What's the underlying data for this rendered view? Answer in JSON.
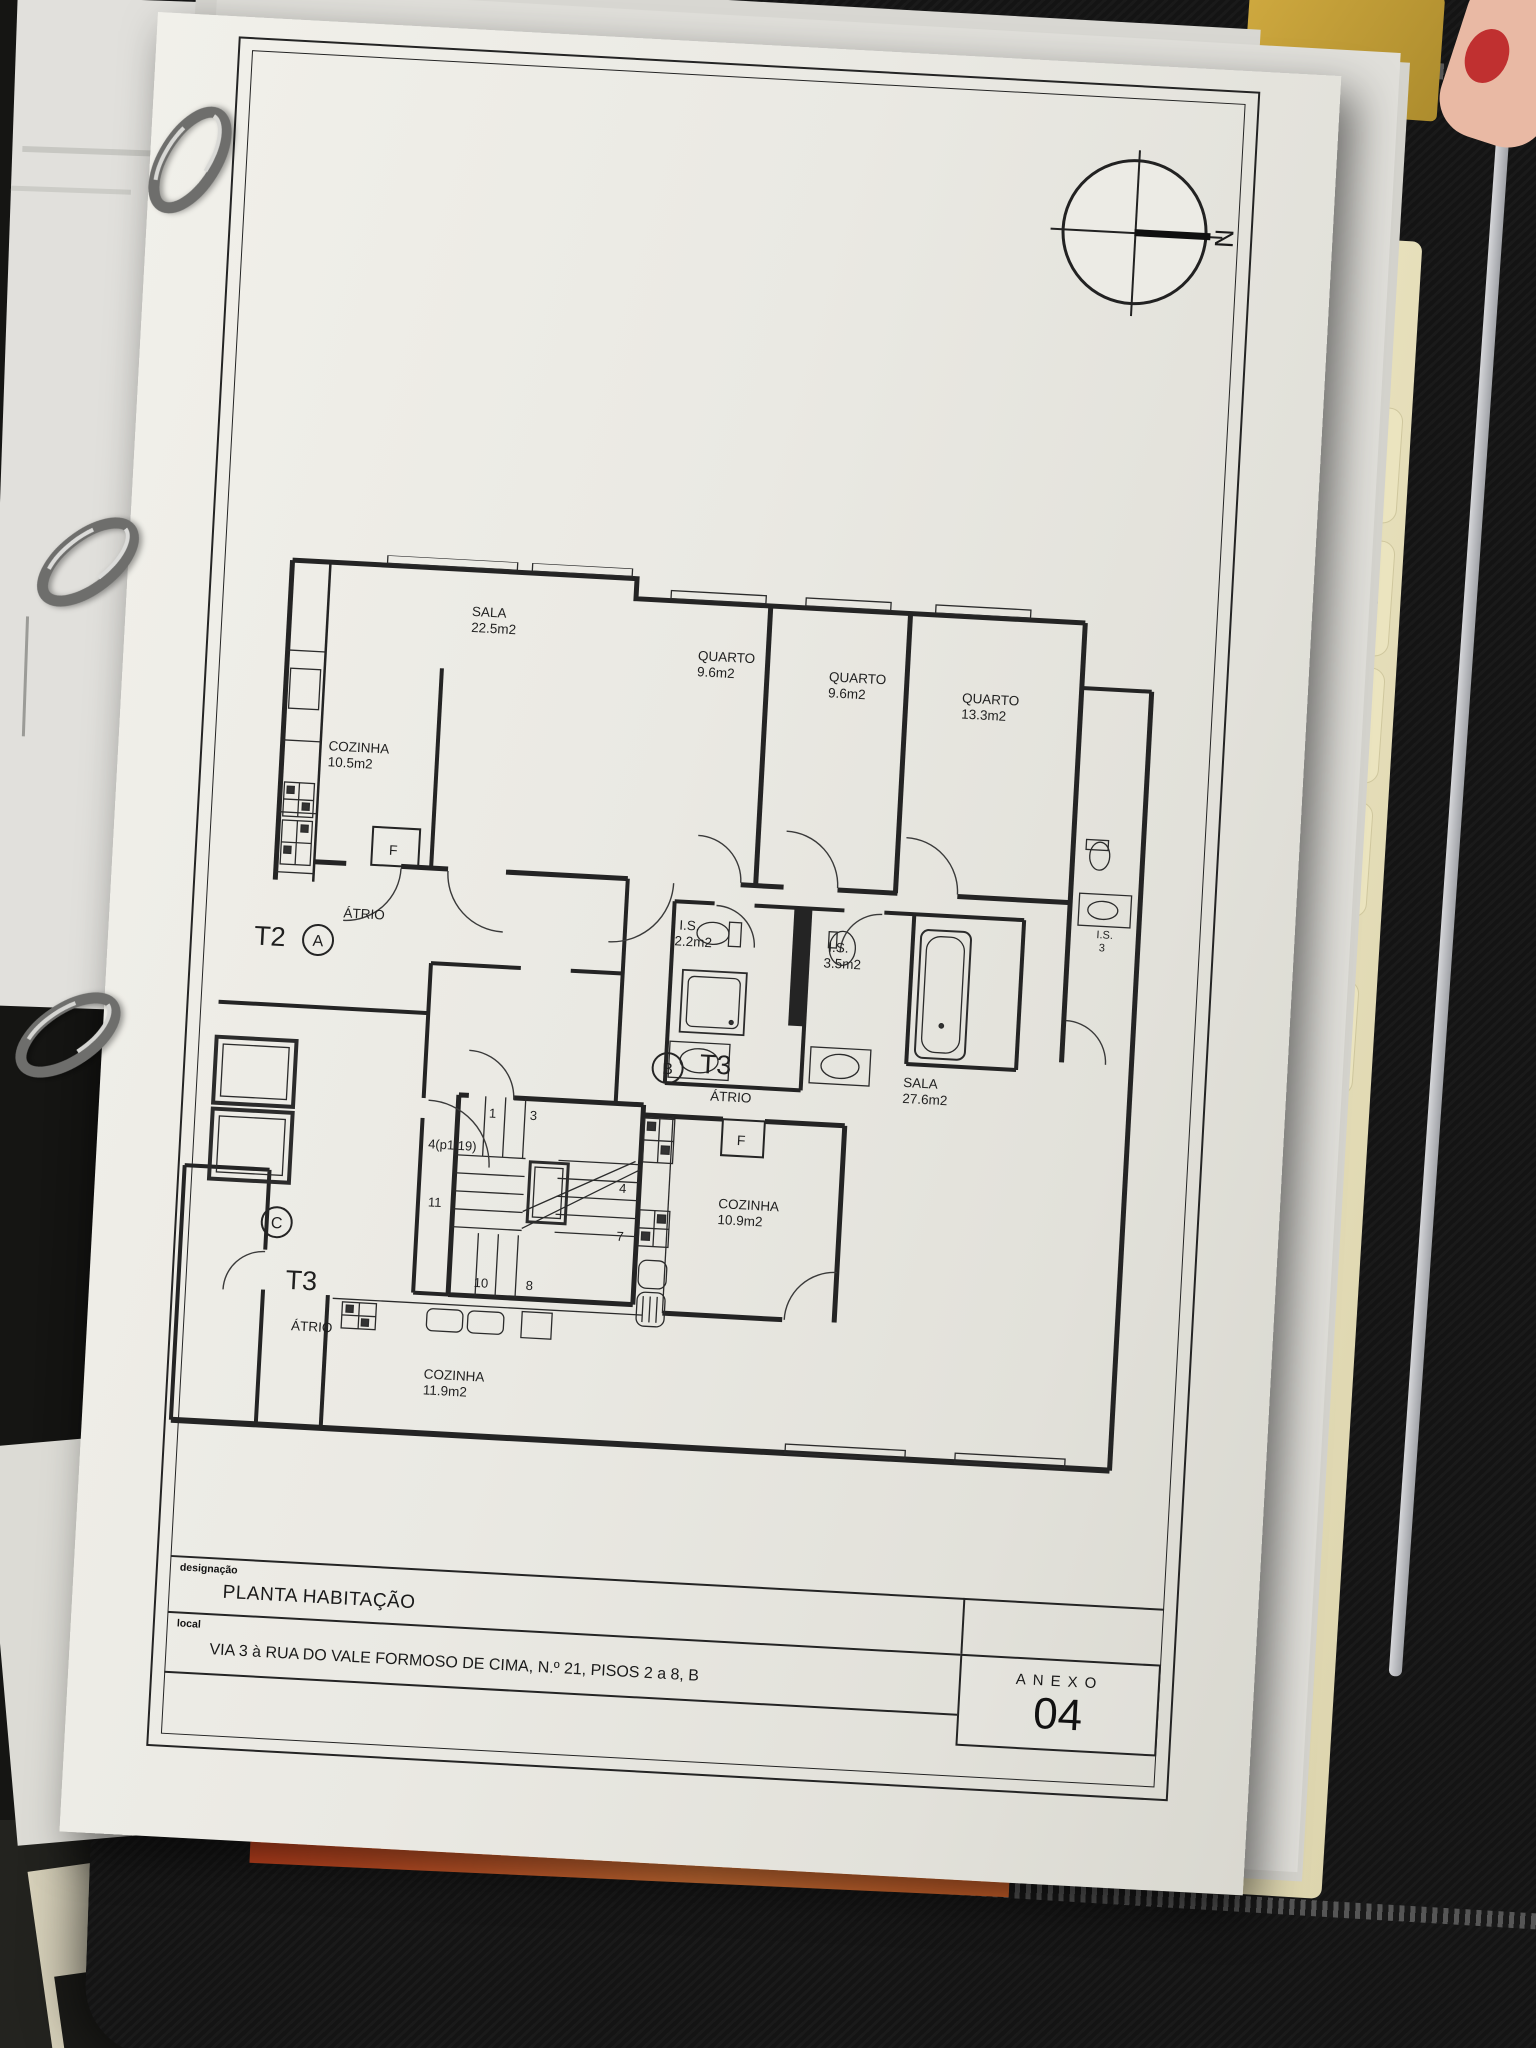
{
  "drawing": {
    "north": "N",
    "rooms": {
      "sala1": {
        "name": "SALA",
        "area": "22.5m2"
      },
      "quarto1": {
        "name": "QUARTO",
        "area": "9.6m2"
      },
      "quarto2": {
        "name": "QUARTO",
        "area": "9.6m2"
      },
      "quarto3": {
        "name": "QUARTO",
        "area": "13.3m2"
      },
      "cozinha1": {
        "name": "COZINHA",
        "area": "10.5m2"
      },
      "is1": {
        "name": "I.S.",
        "area": "2.2m2"
      },
      "is2": {
        "name": "I.S.",
        "area": "3.5m2"
      },
      "is3": {
        "name": "I.S.",
        "area": "3"
      },
      "sala2": {
        "name": "SALA",
        "area": "27.6m2"
      },
      "cozinha2": {
        "name": "COZINHA",
        "area": "10.9m2"
      },
      "cozinha3": {
        "name": "COZINHA",
        "area": "11.9m2"
      }
    },
    "units": {
      "t2a": {
        "type": "T2",
        "letter": "A",
        "atrio": "ÁTRIO"
      },
      "t3b": {
        "type": "T3",
        "letter": "B",
        "atrio": "ÁTRIO"
      },
      "t3c": {
        "type": "T3",
        "letter": "C",
        "atrio": "ÁTRIO"
      }
    },
    "f_marker": "F",
    "stair_numbers": [
      "1",
      "3",
      "4(p1.19)",
      "4",
      "11",
      "7",
      "10",
      "8"
    ],
    "title_block": {
      "designacao_label": "designação",
      "designacao_value": "PLANTA HABITAÇÃO",
      "local_label": "local",
      "local_value": "VIA 3 à RUA DO VALE FORMOSO DE CIMA, N.º 21, PISOS 2 a 8, B",
      "anexo_label": "ANEXO",
      "anexo_number": "04"
    }
  },
  "binder": {
    "tabs": [
      "3",
      "4",
      "5",
      "6",
      "7",
      "8",
      "9",
      "0"
    ]
  },
  "desk": {
    "left_book_words": [
      "Lundi",
      "Montag",
      "Lunes"
    ],
    "calendar_fragments": [
      "Ma",
      "Di",
      "M",
      "di",
      "day",
      "rcoledi",
      "dnesda"
    ]
  }
}
